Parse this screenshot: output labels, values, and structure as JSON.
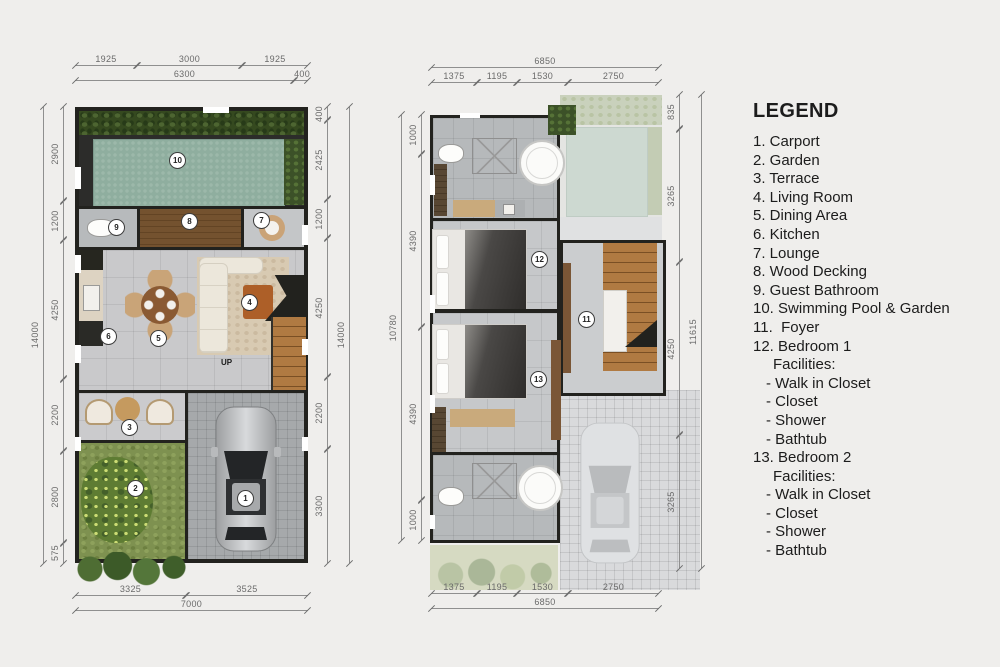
{
  "legend": {
    "title": "LEGEND",
    "items": [
      {
        "t": "1. Carport",
        "c": "l0"
      },
      {
        "t": "2. Garden",
        "c": "l0"
      },
      {
        "t": "3. Terrace",
        "c": "l0"
      },
      {
        "t": "4. Living Room",
        "c": "l0"
      },
      {
        "t": "5. Dining Area",
        "c": "l0"
      },
      {
        "t": "6. Kitchen",
        "c": "l0"
      },
      {
        "t": "7. Lounge",
        "c": "l0"
      },
      {
        "t": "8. Wood Decking",
        "c": "l0"
      },
      {
        "t": "9. Guest Bathroom",
        "c": "l0"
      },
      {
        "t": "10. Swimming Pool & Garden",
        "c": "l0"
      },
      {
        "t": "11.  Foyer",
        "c": "l0"
      },
      {
        "t": "12. Bedroom 1",
        "c": "l0"
      },
      {
        "t": "Facilities:",
        "c": "l1"
      },
      {
        "t": "- Walk in Closet",
        "c": "l2"
      },
      {
        "t": "- Closet",
        "c": "l2"
      },
      {
        "t": "- Shower",
        "c": "l2"
      },
      {
        "t": "- Bathtub",
        "c": "l2"
      },
      {
        "t": "13. Bedroom 2",
        "c": "l0"
      },
      {
        "t": "Facilities:",
        "c": "l1"
      },
      {
        "t": "- Walk in Closet",
        "c": "l2"
      },
      {
        "t": "- Closet",
        "c": "l2"
      },
      {
        "t": "- Shower",
        "c": "l2"
      },
      {
        "t": "- Bathtub",
        "c": "l2"
      }
    ]
  },
  "plans": {
    "ground": {
      "badges": [
        "1",
        "2",
        "3",
        "4",
        "5",
        "6",
        "7",
        "8",
        "9",
        "10"
      ],
      "up_label": "UP",
      "dims": {
        "top1": [
          "1925",
          "3000",
          "1925"
        ],
        "top2": [
          "6300",
          "400"
        ],
        "left": [
          "2900",
          "1200",
          "4250",
          "2200",
          "2800",
          "575"
        ],
        "left_total": "14000",
        "right": [
          "400",
          "2425",
          "1200",
          "4250",
          "2200",
          "3300"
        ],
        "right_total": "14000",
        "bottom": [
          "3325",
          "3525"
        ],
        "bottom_total": "7000"
      }
    },
    "upper": {
      "badges": [
        "11",
        "12",
        "13"
      ],
      "dims": {
        "top_total": "6850",
        "top": [
          "1375",
          "1195",
          "1530",
          "2750"
        ],
        "left": [
          "1000",
          "4390",
          "4390",
          "1000"
        ],
        "left_total": "10780",
        "right": [
          "835",
          "3265",
          "4250",
          "3265"
        ],
        "right_total": "11615",
        "bottom": [
          "1375",
          "1195",
          "1530",
          "2750"
        ],
        "bottom_total": "6850"
      }
    }
  },
  "colors": {
    "pool": "#8fae9f",
    "grass": "#7e9150",
    "wood_decking": "#74522f",
    "stairs": "#b07a42",
    "wall": "#22221e",
    "tile": "#c9c9cb",
    "dimension_line": "#8f8f8f",
    "background": "#efeeec"
  }
}
